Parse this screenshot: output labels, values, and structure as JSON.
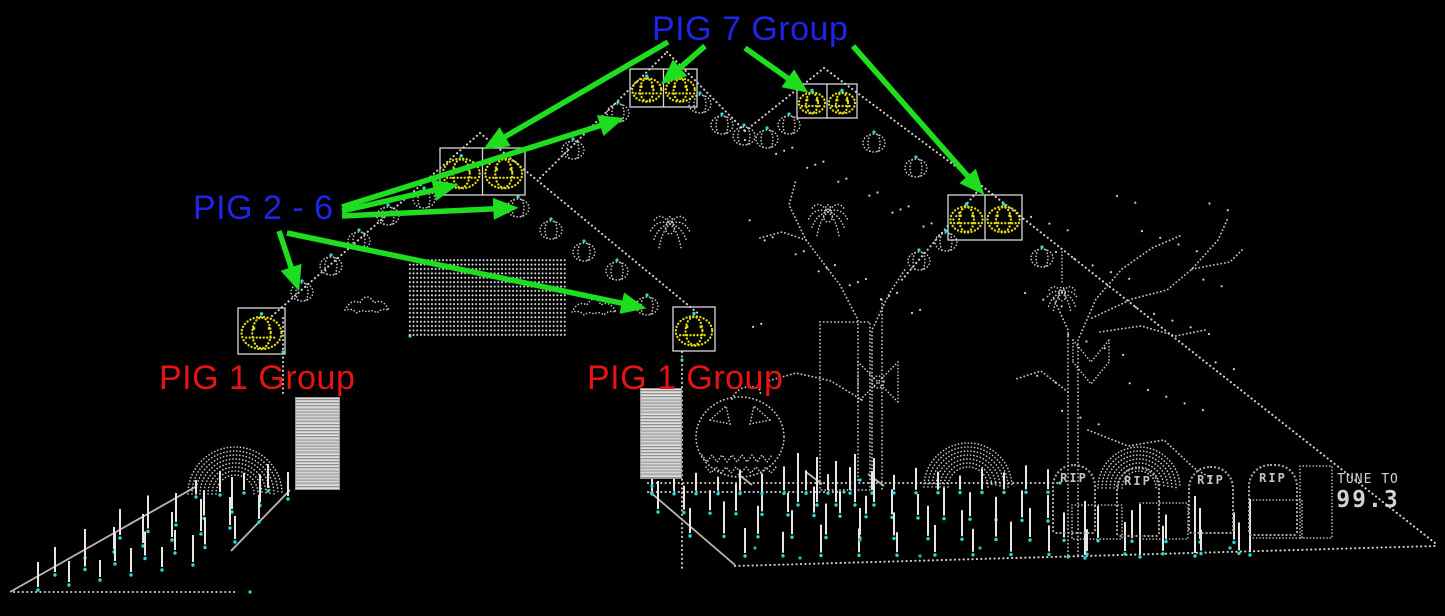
{
  "annotations": {
    "pig7": {
      "label": "PIG 7 Group",
      "color": "#2024e8"
    },
    "pig26": {
      "label": "PIG 2 - 6",
      "color": "#2024e8"
    },
    "pig1_left": {
      "label": "PIG 1 Group",
      "color": "#e81414"
    },
    "pig1_center": {
      "label": "PIG 1 Group",
      "color": "#e81414"
    }
  },
  "sign": {
    "line1": "TUNE TO",
    "line2": "99.3"
  },
  "graveyard": {
    "tombstones": [
      {
        "label": "RIP"
      },
      {
        "label": "RIP"
      },
      {
        "label": "RIP"
      },
      {
        "label": "RIP"
      }
    ]
  },
  "colors": {
    "arrow": "#1fdd1f",
    "dots": "#d2d2d2",
    "pumpkin": "#e4dd10",
    "accent": "#1fe0e0",
    "grass": "#1fd060"
  },
  "arrows": [
    [
      705,
      46,
      666,
      80
    ],
    [
      668,
      42,
      489,
      146
    ],
    [
      745,
      48,
      803,
      89
    ],
    [
      853,
      46,
      980,
      190
    ],
    [
      342,
      207,
      618,
      120
    ],
    [
      342,
      211,
      452,
      186
    ],
    [
      342,
      216,
      512,
      208
    ],
    [
      279,
      231,
      297,
      285
    ],
    [
      287,
      233,
      640,
      307
    ]
  ],
  "scene": {
    "dot_lines": [
      [
        272,
        316,
        480,
        133
      ],
      [
        480,
        133,
        700,
        315
      ],
      [
        283,
        318,
        283,
        397
      ],
      [
        682,
        352,
        682,
        568
      ],
      [
        540,
        178,
        667,
        52
      ],
      [
        667,
        52,
        745,
        131
      ],
      [
        745,
        131,
        824,
        68
      ],
      [
        824,
        68,
        982,
        186
      ],
      [
        982,
        186,
        900,
        282
      ],
      [
        982,
        186,
        1435,
        543
      ],
      [
        14,
        592,
        235,
        592
      ],
      [
        735,
        566,
        1435,
        546
      ],
      [
        648,
        483,
        1058,
        483
      ],
      [
        648,
        492,
        838,
        492
      ]
    ],
    "solid_lines": [
      [
        10,
        592,
        197,
        486
      ],
      [
        290,
        490,
        231,
        551
      ],
      [
        650,
        492,
        735,
        565
      ]
    ],
    "pennants": [
      [
        738,
        474,
        752,
        485
      ],
      [
        806,
        472,
        822,
        484
      ],
      [
        868,
        474,
        884,
        486
      ]
    ],
    "polylines": [
      [
        [
          858,
          480
        ],
        [
          858,
          320
        ],
        [
          840,
          285
        ],
        [
          806,
          240
        ],
        [
          789,
          205
        ],
        [
          796,
          180
        ]
      ],
      [
        [
          872,
          480
        ],
        [
          872,
          330
        ],
        [
          889,
          294
        ],
        [
          906,
          268
        ]
      ],
      [
        [
          862,
          400
        ],
        [
          831,
          381
        ],
        [
          796,
          373
        ],
        [
          768,
          381
        ]
      ],
      [
        [
          806,
          240
        ],
        [
          782,
          232
        ],
        [
          760,
          238
        ]
      ],
      [
        [
          882,
          300
        ],
        [
          882,
          490
        ]
      ],
      [
        [
          1068,
          555
        ],
        [
          1068,
          330
        ],
        [
          1054,
          299
        ]
      ],
      [
        [
          1078,
          555
        ],
        [
          1078,
          340
        ],
        [
          1096,
          299
        ],
        [
          1122,
          269
        ],
        [
          1152,
          248
        ],
        [
          1182,
          235
        ]
      ],
      [
        [
          1092,
          318
        ],
        [
          1132,
          299
        ],
        [
          1167,
          290
        ],
        [
          1192,
          269
        ],
        [
          1218,
          240
        ],
        [
          1228,
          218
        ]
      ],
      [
        [
          1192,
          269
        ],
        [
          1230,
          262
        ],
        [
          1242,
          250
        ]
      ],
      [
        [
          1100,
          332
        ],
        [
          1141,
          326
        ],
        [
          1176,
          336
        ],
        [
          1205,
          330
        ]
      ],
      [
        [
          1088,
          430
        ],
        [
          1128,
          446
        ],
        [
          1164,
          440
        ],
        [
          1194,
          468
        ],
        [
          1214,
          480
        ]
      ],
      [
        [
          1068,
          392
        ],
        [
          1041,
          371
        ],
        [
          1016,
          379
        ]
      ]
    ],
    "arches": [
      {
        "cx": 235,
        "cy": 494,
        "r": 47,
        "rings": 8
      },
      {
        "cx": 968,
        "cy": 487,
        "r": 44,
        "rings": 7
      },
      {
        "cx": 1139,
        "cy": 488,
        "r": 41,
        "rings": 7
      }
    ],
    "matrix": {
      "x": 408,
      "y": 258,
      "w": 158,
      "h": 80
    },
    "pillars": [
      {
        "x": 295,
        "y": 397,
        "w": 43,
        "h": 91
      },
      {
        "x": 640,
        "y": 388,
        "w": 40,
        "h": 89
      }
    ],
    "door": {
      "x": 820,
      "y": 322,
      "w": 50,
      "h": 168
    },
    "pumpkin_boxes": [
      {
        "x": 630,
        "y": 69,
        "w": 67,
        "h": 38,
        "cells": 2
      },
      {
        "x": 797,
        "y": 84,
        "w": 60,
        "h": 34,
        "cells": 2
      },
      {
        "x": 440,
        "y": 148,
        "w": 85,
        "h": 47,
        "cells": 2
      },
      {
        "x": 948,
        "y": 195,
        "w": 74,
        "h": 45,
        "cells": 2
      },
      {
        "x": 238,
        "y": 308,
        "w": 47,
        "h": 46,
        "cells": 1
      },
      {
        "x": 673,
        "y": 307,
        "w": 42,
        "h": 44,
        "cells": 1
      }
    ],
    "pumpkins": [
      [
        302,
        292
      ],
      [
        331,
        266
      ],
      [
        359,
        241
      ],
      [
        388,
        216
      ],
      [
        424,
        199
      ],
      [
        518,
        208
      ],
      [
        551,
        230
      ],
      [
        584,
        252
      ],
      [
        617,
        271
      ],
      [
        647,
        306
      ],
      [
        573,
        150
      ],
      [
        618,
        113
      ],
      [
        700,
        104
      ],
      [
        722,
        125
      ],
      [
        744,
        136
      ],
      [
        767,
        139
      ],
      [
        789,
        125
      ],
      [
        874,
        143
      ],
      [
        916,
        168
      ],
      [
        919,
        261
      ],
      [
        946,
        242
      ],
      [
        1042,
        258
      ]
    ],
    "spiders": [
      [
        670,
        228,
        1
      ],
      [
        828,
        216,
        1
      ],
      [
        1062,
        296,
        0.8
      ]
    ],
    "spider_thread": [
      1062,
      252,
      1062,
      282
    ],
    "bats": [
      [
        367,
        306
      ],
      [
        594,
        308
      ]
    ],
    "jack": {
      "cx": 740,
      "cy": 437,
      "rx": 44,
      "ry": 40
    },
    "webx": {
      "cx": 878,
      "cy": 382
    },
    "webdiamond": {
      "cx": 1091,
      "cy": 362
    },
    "bases": [
      [
        1072,
        505,
        50,
        34
      ],
      [
        1140,
        503,
        48,
        36
      ],
      [
        1250,
        500,
        52,
        38
      ],
      [
        1300,
        466,
        32,
        72
      ]
    ],
    "stake_rows": [
      {
        "x0": 196,
        "y0": 497,
        "dx": 24,
        "dy": -2,
        "n": 4,
        "h": 22
      },
      {
        "x0": 120,
        "y0": 538,
        "dx": 28,
        "dy": -6.5,
        "n": 7,
        "h": 32
      },
      {
        "x0": 85,
        "y0": 558,
        "dx": 29,
        "dy": -6,
        "n": 7,
        "h": 30
      },
      {
        "x0": 55,
        "y0": 575,
        "dx": 30,
        "dy": -5.5,
        "n": 7,
        "h": 27
      },
      {
        "x0": 38,
        "y0": 590,
        "dx": 31,
        "dy": -5,
        "n": 6,
        "h": 25
      },
      {
        "x0": 658,
        "y0": 512,
        "dx": 26,
        "dy": 0.6,
        "n": 16,
        "h": 26
      },
      {
        "x0": 652,
        "y0": 494,
        "dx": 22,
        "dy": -0.1,
        "n": 19,
        "h": 22
      },
      {
        "x0": 690,
        "y0": 536,
        "dx": 34,
        "dy": 0.4,
        "n": 17,
        "h": 30
      },
      {
        "x0": 745,
        "y0": 556,
        "dx": 38,
        "dy": -0.2,
        "n": 14,
        "h": 28
      },
      {
        "x0": 1085,
        "y0": 558,
        "dx": 55,
        "dy": -1,
        "n": 4,
        "h": 55
      },
      {
        "x0": 798,
        "y0": 505,
        "dx": 19,
        "dy": 0,
        "n": 5,
        "h": 48
      }
    ],
    "dot_fields": [
      {
        "x": 745,
        "y": 140,
        "w": 190,
        "h": 190,
        "n": 34
      },
      {
        "x": 1025,
        "y": 195,
        "w": 215,
        "h": 235,
        "n": 42
      }
    ],
    "cyan_dots": [
      [
        410,
        336
      ],
      [
        283,
        352
      ],
      [
        682,
        360
      ],
      [
        860,
        480
      ],
      [
        1068,
        557
      ],
      [
        652,
        486
      ],
      [
        1060,
        483
      ],
      [
        250,
        592
      ],
      [
        844,
        492
      ],
      [
        1230,
        548
      ]
    ],
    "green_dots": [
      [
        755,
        548
      ],
      [
        800,
        558
      ],
      [
        860,
        540
      ],
      [
        920,
        556
      ],
      [
        980,
        548
      ]
    ]
  }
}
